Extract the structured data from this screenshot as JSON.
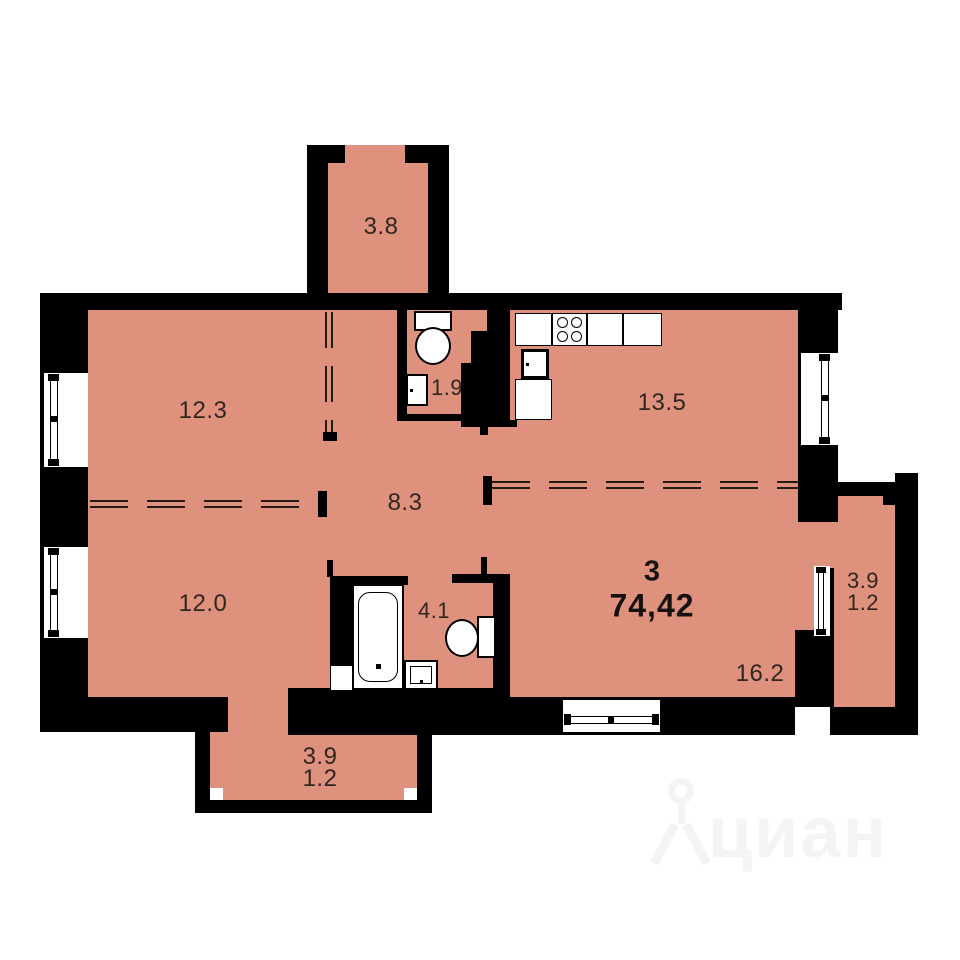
{
  "plan": {
    "summary": {
      "rooms_count": "3",
      "total_area": "74,42"
    },
    "rooms": {
      "balcony_top": {
        "area": "3.8"
      },
      "bedroom_top": {
        "area": "12.3"
      },
      "wc": {
        "area": "1.9"
      },
      "kitchen": {
        "area": "13.5"
      },
      "hallway": {
        "area": "8.3"
      },
      "bedroom_bottom": {
        "area": "12.0"
      },
      "bathroom": {
        "area": "4.1"
      },
      "living_room": {
        "area": "16.2"
      },
      "balcony_right": {
        "area": "3.9",
        "reduced_area": "1.2"
      },
      "balcony_bottom": {
        "area": "3.9",
        "reduced_area": "1.2"
      }
    },
    "colors": {
      "floor": "#DE927E",
      "wall": "#000000",
      "label_text": "#30261F",
      "dash_line": "#241A12",
      "watermark": "#F4F4F4"
    }
  },
  "watermark": {
    "text": "циан"
  }
}
